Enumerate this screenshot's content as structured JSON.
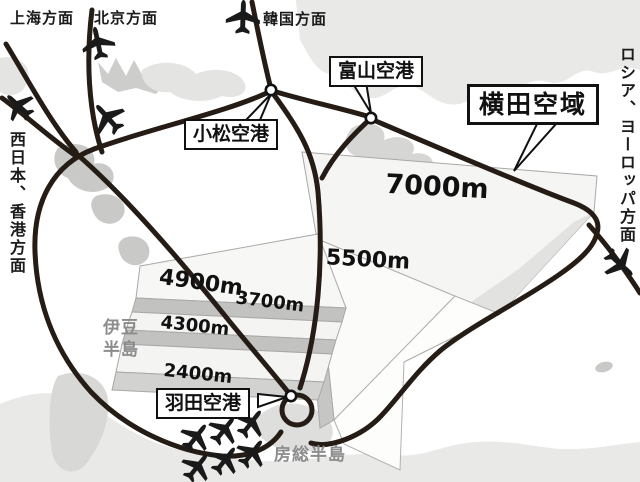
{
  "diagram": {
    "title_box": "横田空域",
    "directions": {
      "shanghai": "上海方面",
      "beijing": "北京方面",
      "korea": "韓国方面",
      "russia_europe": "ロシア、ヨーロッパ方面",
      "west_japan_hongkong": "西日本、香港方面"
    },
    "airports": {
      "komatsu": "小松空港",
      "toyama": "富山空港",
      "haneda": "羽田空港"
    },
    "altitudes": {
      "a7000": "7000m",
      "a5500": "5500m",
      "a4900": "4900m",
      "a3700": "3700m",
      "a4300": "4300m",
      "a2400": "2400m"
    },
    "places": {
      "izu_line1": "伊豆",
      "izu_line2": "半島",
      "boso": "房総半島"
    },
    "colors": {
      "route": "#251c15",
      "land": "#e9e9e8",
      "land_mid": "#d6d6d5",
      "land_shadow": "#c9c9c8",
      "block_face": "#f5f5f4",
      "block_riser": "#c2c2c1",
      "outline": "#111111"
    }
  }
}
